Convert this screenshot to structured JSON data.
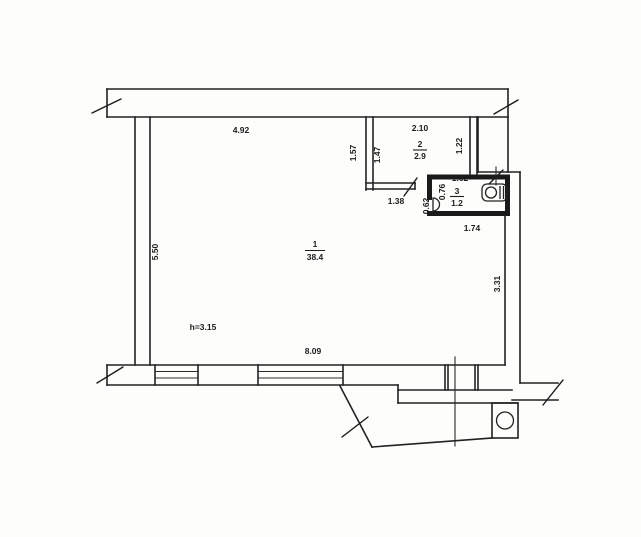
{
  "plan": {
    "rooms": [
      {
        "id": "room-1",
        "number": "1",
        "area": "38.4"
      },
      {
        "id": "room-2",
        "number": "2",
        "area": "2.9"
      },
      {
        "id": "room-3",
        "number": "3",
        "area": "1.2"
      }
    ],
    "height_note": "h=3.15",
    "dimensions": {
      "top_width": "4.92",
      "room2_width": "2.10",
      "room2_depth_outer": "1.57",
      "room2_left_depth": "1.47",
      "room2_right_depth": "1.22",
      "hall_width": "1.38",
      "wc_door_offset": "0.62",
      "wc_depth": "0.76",
      "wc_width": "1.62",
      "wc_outer_width": "1.74",
      "left_height": "5.50",
      "right_lower_height": "3.31",
      "bottom_width": "8.09"
    },
    "icons": {
      "toilet": "toilet-icon",
      "sink": "sink-icon",
      "balcony_column": "column-icon"
    },
    "colors": {
      "ink": "#222222",
      "paper": "#fdfdfc"
    }
  }
}
